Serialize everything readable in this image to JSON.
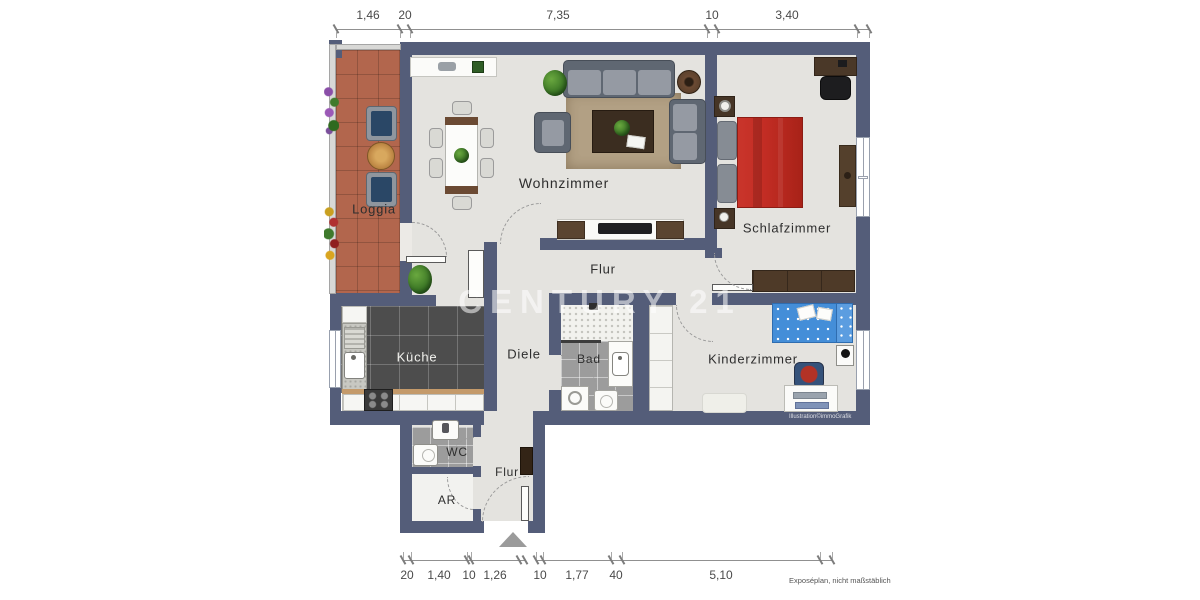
{
  "plan": {
    "watermark": "CENTURY 21",
    "credit": "Illustration©immoGrafik",
    "footnote": "Exposéplan, nicht maßstäblich",
    "rooms": {
      "loggia": "Loggia",
      "wohnzimmer": "Wohnzimmer",
      "schlafzimmer": "Schlafzimmer",
      "flur_oben": "Flur",
      "kueche": "Küche",
      "diele": "Diele",
      "bad": "Bad",
      "kinderzimmer": "Kinderzimmer",
      "wc": "WC",
      "ar": "AR",
      "flur_unten": "Flur"
    },
    "dims_top": [
      "1,46",
      "20",
      "7,35",
      "10",
      "3,40"
    ],
    "dims_bottom": [
      "20",
      "1,40",
      "10",
      "1,26",
      "10",
      "1,77",
      "40",
      "5,10"
    ],
    "colors": {
      "wall": "#545d79",
      "floor": "#e4e3df",
      "loggia_tile": "#b2664d",
      "bed_red": "#c32d24",
      "kid_bed_blue": "#448ed8"
    }
  }
}
